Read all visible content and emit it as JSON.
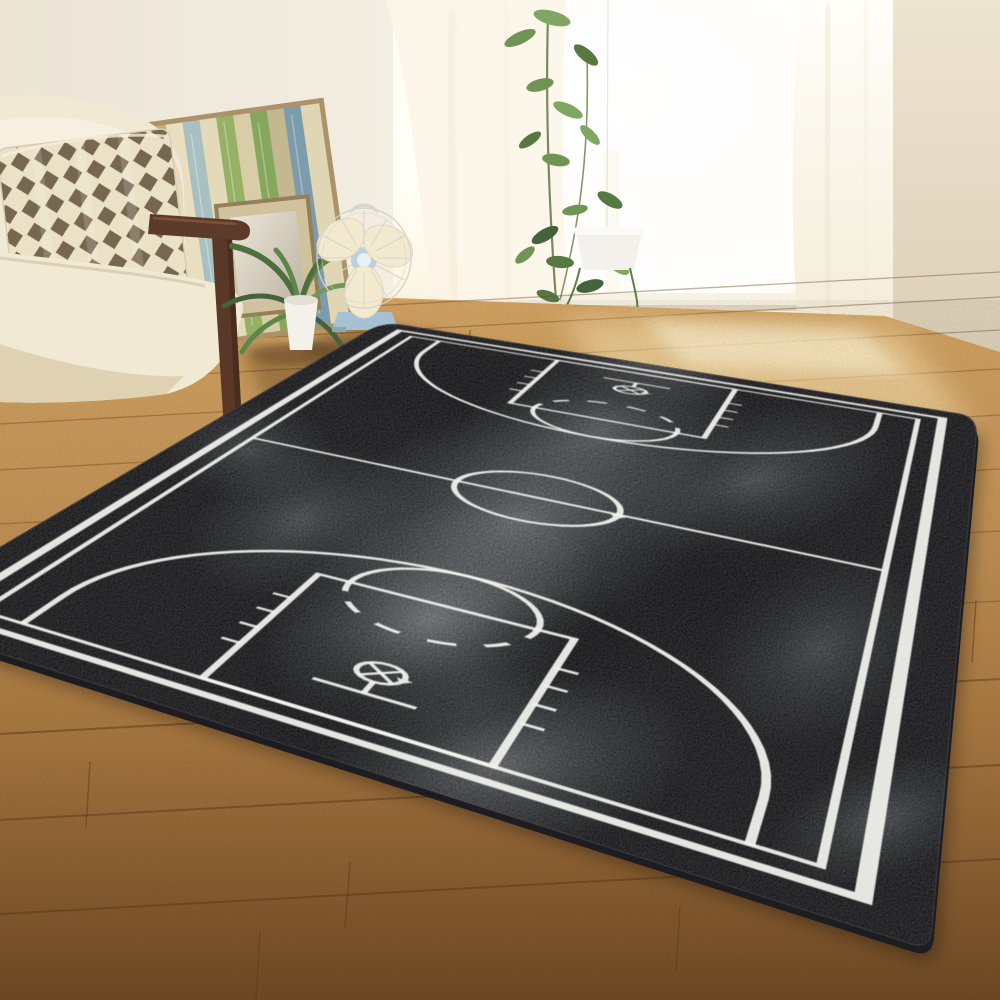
{
  "meta": {
    "type": "product-photo",
    "subject": "3D basketball court print black area rug in a sunlit living room",
    "width_px": 1000,
    "height_px": 1000
  },
  "palette": {
    "wall": "#f1ebdf",
    "wall_right": "#e9dfcc",
    "window_glow": "#fdf6e2",
    "curtain": "#fbf5e7",
    "sill": "#f7f2e4",
    "floor_light": "#d3a463",
    "floor_mid": "#ab7a42",
    "floor_dark": "#6f4a25",
    "sun_patch": "#ffedbe",
    "rug_base": "#121216",
    "rug_side": "#1c1c21",
    "rug_patch": "#9BA0A4",
    "court_line": "#f3f3ef",
    "sofa_cream": "#f1e9d4",
    "sofa_shade": "#dccead",
    "sofa_wood": "#5d3b2a",
    "pillow_bg": "#ebe1c6",
    "pillow_diamond": "#786750",
    "pot_white": "#f3f1ea",
    "plant_green": "#5c8146",
    "plant_green_dark": "#44633a",
    "fan_blade": "#f2e9cf",
    "fan_base": "#a6c1d3",
    "fan_cage": "#d3d3c9",
    "panel_frame": "#ab9268",
    "shadow_brown": "#3a2410"
  },
  "rug": {
    "quad": {
      "n": [
        383,
        322
      ],
      "e": [
        978,
        417
      ],
      "s": [
        930,
        950
      ],
      "w": [
        -117,
        616
      ]
    },
    "court": {
      "rug_w": 16.6,
      "rug_l": 29.6,
      "border_margin": 0.8,
      "court_margin": 1.35,
      "border_halfw": 0.11,
      "line_halfw": 0.068,
      "key_width": 4.9,
      "key_length": 5.8,
      "ft_radius": 1.8,
      "center_radius": 1.8,
      "three_pt_radius": 6.05,
      "three_pt_side_offset": 0.9,
      "hoop_dist": 2.14,
      "hoop_radius": 0.42,
      "backboard_dist": 1.2,
      "backboard_width": 1.8,
      "tick_dists": [
        1.75,
        2.6,
        3.45,
        4.3
      ],
      "corner_round_px": 20
    }
  },
  "objects": {
    "rug_label": "black watercolor basketball-court rug",
    "sofa_label": "cream fabric sofa with wooden armrest",
    "pillow_label": "brown diamond-check throw pillow",
    "panel_art_label": "striped reclaimed-wood wall panel with small mirror",
    "floor_plant_label": "potted green plant",
    "fan_label": "vintage desk fan with blue base",
    "window_plant_label": "tall window plant with hanging planter",
    "curtain_label": "sheer white curtains",
    "floor_label": "warm wooden plank floor"
  }
}
